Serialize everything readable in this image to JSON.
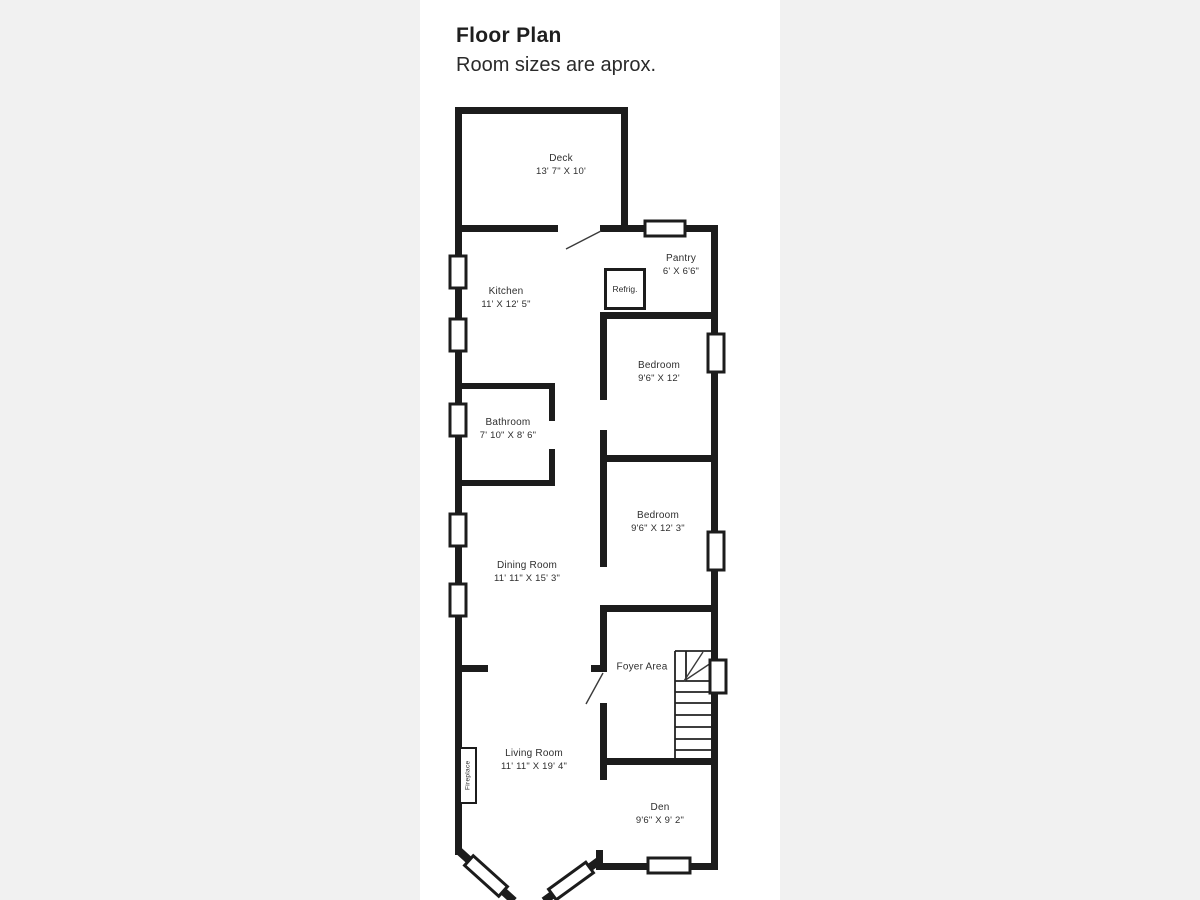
{
  "header": {
    "title": "Floor Plan",
    "subtitle": "Room sizes are aprox."
  },
  "colors": {
    "wall": "#1c1c1c",
    "background": "#f1f1f1",
    "paper": "#ffffff"
  },
  "rooms": [
    {
      "name": "Deck",
      "dims": "13' 7\" X 10'"
    },
    {
      "name": "Kitchen",
      "dims": "11' X 12' 5\""
    },
    {
      "name": "Pantry",
      "dims": "6' X 6'6\""
    },
    {
      "name": "Bedroom",
      "dims": "9'6\" X 12'"
    },
    {
      "name": "Bathroom",
      "dims": "7' 10\" X 8' 6\""
    },
    {
      "name": "Bedroom",
      "dims": "9'6\" X 12' 3\""
    },
    {
      "name": "Dining Room",
      "dims": "11' 11\" X 15' 3\""
    },
    {
      "name": "Foyer Area",
      "dims": ""
    },
    {
      "name": "Living Room",
      "dims": "11' 11\" X 19' 4\""
    },
    {
      "name": "Den",
      "dims": "9'6\" X 9' 2\""
    }
  ],
  "fixtures": {
    "refrigerator": "Refrig.",
    "fireplace": "Fireplace"
  }
}
